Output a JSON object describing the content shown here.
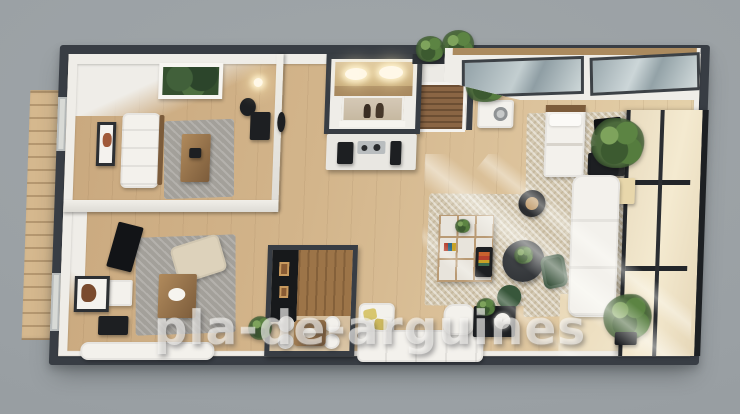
{
  "scene": {
    "title": "3D apartment floor plan render",
    "watermark": "pla-de-arguines",
    "rooms": [
      {
        "name": "lounge"
      },
      {
        "name": "bedroom-office"
      },
      {
        "name": "bathroom"
      },
      {
        "name": "kitchenette"
      },
      {
        "name": "entry-closet"
      },
      {
        "name": "dining-nook"
      },
      {
        "name": "living-area"
      },
      {
        "name": "bedroom-suite"
      },
      {
        "name": "terrace"
      },
      {
        "name": "balcony-deck"
      }
    ]
  },
  "palette": {
    "bg": "#9aa0a4",
    "wall-dark": "#383d44",
    "wall-face": "#efede8",
    "floor-a": "#c9a87e",
    "floor-b": "#ddc49d",
    "deck": "#d5b88e",
    "rug-gray": "#a3a09a",
    "rug-beige": "#d3c8b1",
    "white-soft": "#f3f1ec",
    "wood-mid": "#b08a5c",
    "wood-dark": "#7c5c3b",
    "green-dark": "#2f4a33",
    "green-mid": "#4c6a3c",
    "glass-cool": "#aab6ba",
    "glass-warm": "#eddfc2",
    "black-fix": "#1d1f22",
    "yellow-pillow": "#d8c66e",
    "wm-color": "rgba(250,248,244,0.58)"
  }
}
